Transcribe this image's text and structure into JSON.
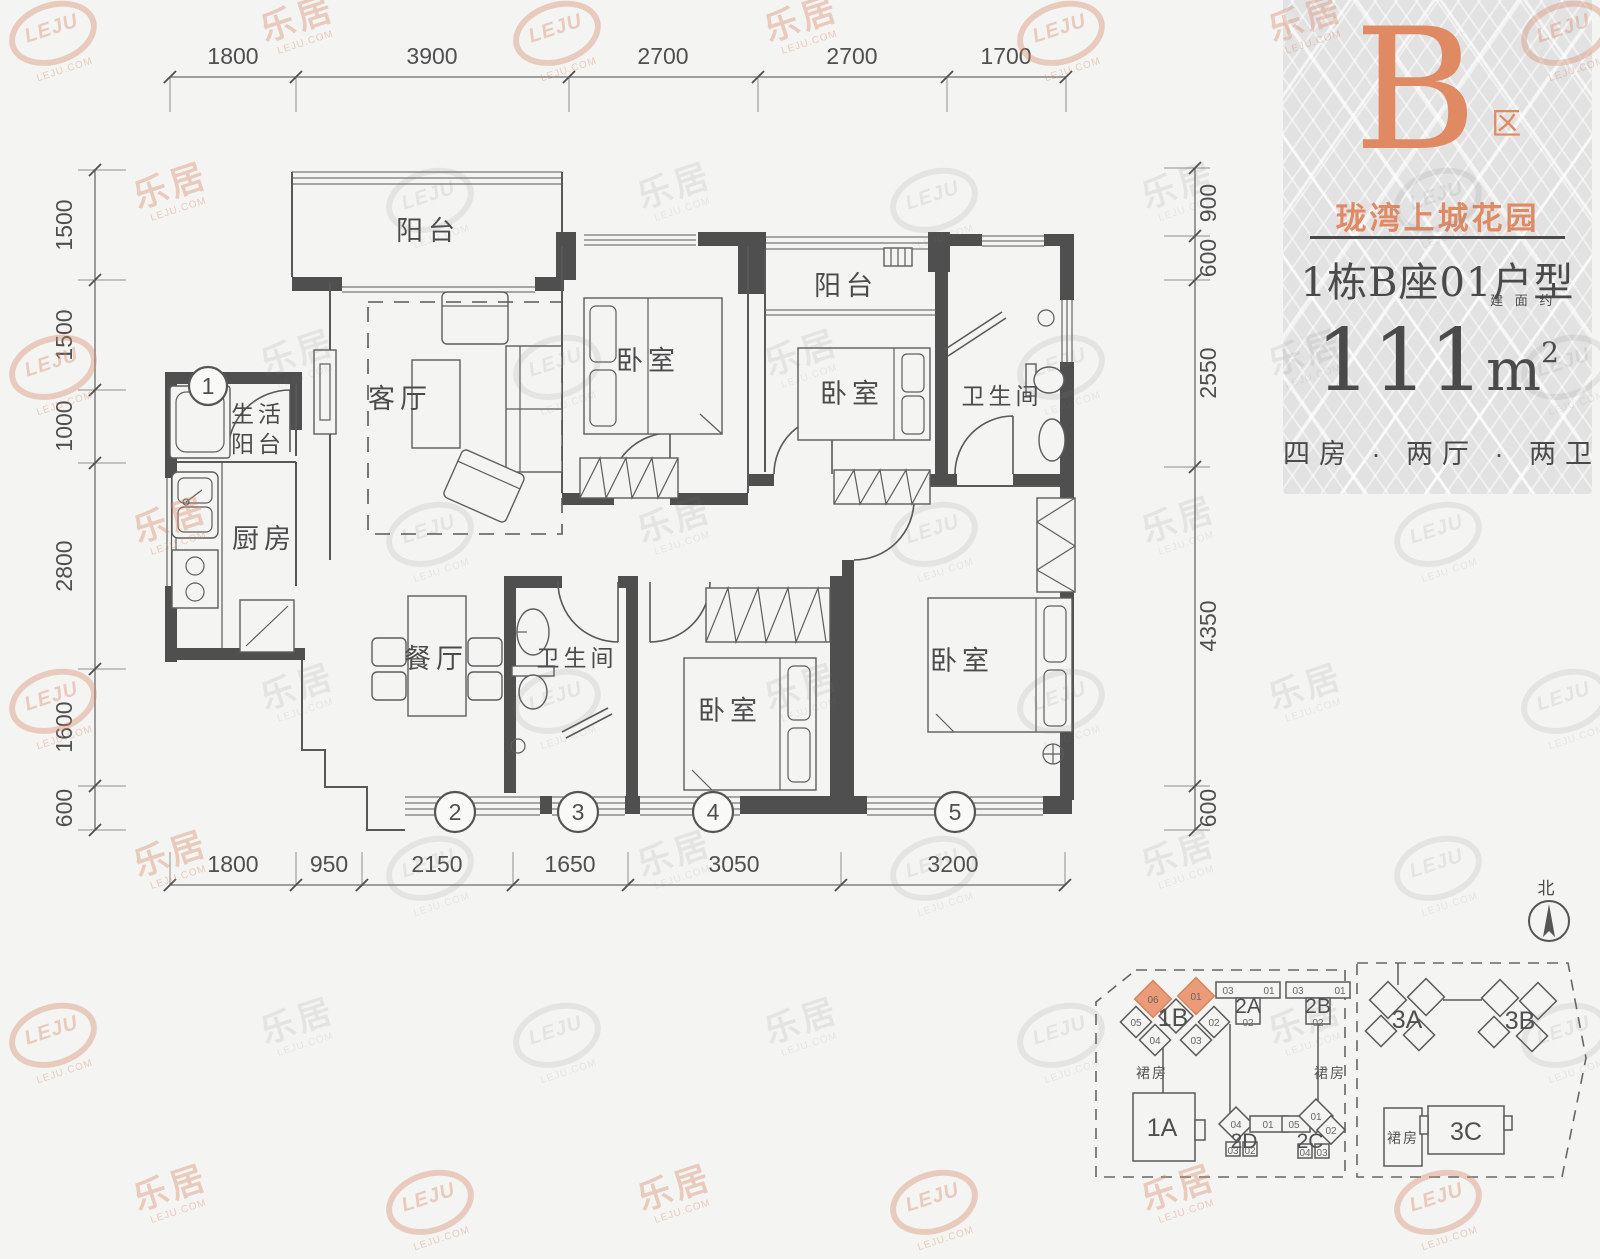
{
  "panel": {
    "zone_letter": "B",
    "zone_suffix": "区",
    "project_name": "珑湾上城花园",
    "unit_title": "1栋B座01户型",
    "area_prefix": "建 面 约",
    "area_value": "111",
    "area_unit": "m",
    "area_sup": "2",
    "layout_desc": "四房 · 两厅 · 两卫"
  },
  "dims": {
    "top": [
      "1800",
      "3900",
      "2700",
      "2700",
      "1700"
    ],
    "bottom": [
      "1800",
      "950",
      "2150",
      "1650",
      "3050",
      "3200"
    ],
    "left": [
      "1500",
      "1500",
      "1000",
      "2800",
      "1600",
      "600"
    ],
    "right": [
      "900",
      "600",
      "2550",
      "4350",
      "600"
    ]
  },
  "rooms": {
    "balcony_top": "阳台",
    "living": "客厅",
    "bedroom1": "卧室",
    "balcony2": "阳台",
    "bedroom2": "卧室",
    "bath1": "卫生间",
    "service_balcony_l1": "生活",
    "service_balcony_l2": "阳台",
    "kitchen": "厨房",
    "dining": "餐厅",
    "bath2": "卫生间",
    "bedroom3": "卧室",
    "bedroom4": "卧室"
  },
  "axis_markers": [
    "1",
    "2",
    "3",
    "4",
    "5"
  ],
  "north_label": "北",
  "siteplan": {
    "podium_label": "裙房",
    "buildings": {
      "b1a": "1A",
      "b1b": "1B",
      "b2a": "2A",
      "b2b": "2B",
      "b2c": "2C",
      "b2d": "2D",
      "b3a": "3A",
      "b3b": "3B",
      "b3c": "3C"
    },
    "units_1b": [
      "06",
      "01",
      "05",
      "04",
      "03",
      "02"
    ],
    "units_2a": [
      "03",
      "01",
      "02"
    ],
    "units_2b": [
      "03",
      "01",
      "02"
    ],
    "units_2d": [
      "04",
      "01",
      "03",
      "02"
    ],
    "units_2c": [
      "05",
      "01",
      "02",
      "04",
      "03"
    ],
    "highlight_units": [
      "06",
      "01"
    ]
  },
  "colors": {
    "accent": "#e08a64",
    "wall": "#4f4f4f",
    "background": "#f4f4f2",
    "panel_bg": "#e2e2e3",
    "text": "#4a4a4a"
  },
  "watermark": {
    "cn": "乐居",
    "en": "LEJU.COM",
    "logo": "LEJU"
  }
}
